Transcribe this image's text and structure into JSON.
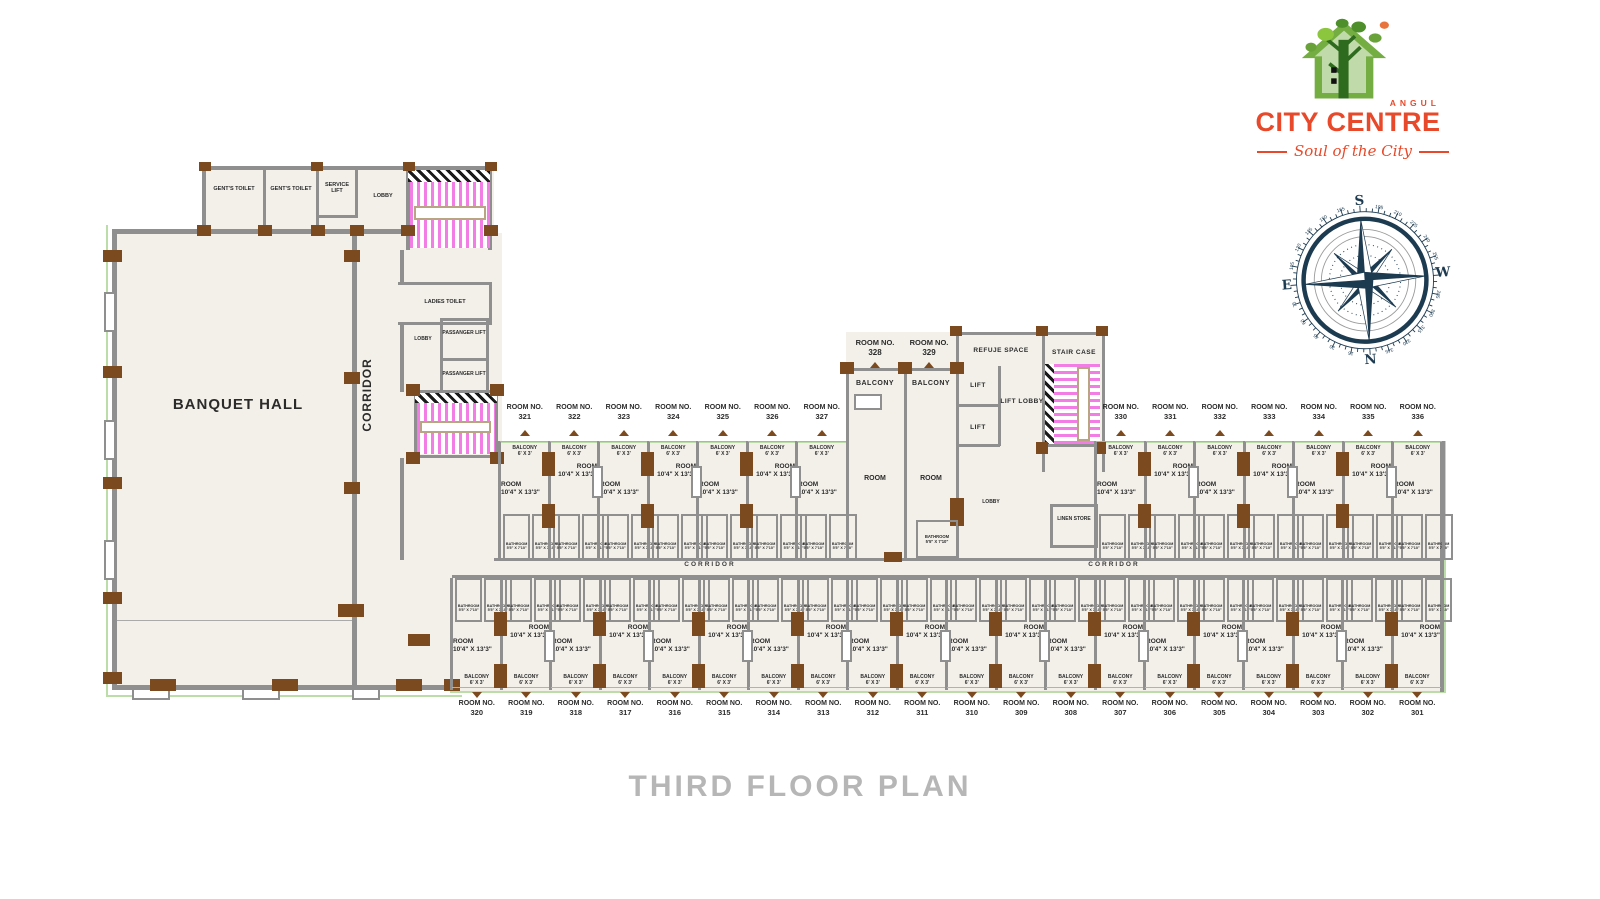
{
  "title": "THIRD FLOOR PLAN",
  "logo": {
    "brand_top": "ANGUL",
    "brand_name": "CITY CENTRE",
    "tagline": "Soul of the City"
  },
  "compass": {
    "s": "S",
    "n": "N",
    "e": "E",
    "w": "W",
    "degrees": [
      15,
      30,
      45,
      60,
      75,
      105,
      120,
      135,
      150,
      165,
      195,
      210,
      225,
      240,
      255,
      285,
      300,
      315,
      330,
      345
    ]
  },
  "left": {
    "gents_toilet": "GENT'S TOILET",
    "gents_toilet_2": "GENT'S TOILET",
    "service_lift": "SERVICE LIFT",
    "lobby": "LOBBY",
    "banquet_hall": "BANQUET HALL",
    "corridor": "CORRIDOR",
    "ladies_toilet": "LADIES TOILET",
    "lobby_2": "LOBBY",
    "passanger_lift": "PASSANGER LIFT",
    "passanger_lift_2": "PASSANGER LIFT"
  },
  "mid": {
    "room_no_label": "ROOM NO.",
    "room_328": "328",
    "room_329": "329",
    "balcony": "BALCONY",
    "room": "ROOM",
    "refuje_space": "REFUJE SPACE",
    "stair_case": "STAIR CASE",
    "lift_1": "LIFT",
    "lift_2": "LIFT",
    "lift_lobby": "LIFT LOBBY",
    "lobby": "LOBBY",
    "linen_store": "LINEN STORE",
    "bathroom": "BATHROOM",
    "bathroom_dims": "5'5\" X 7'10\""
  },
  "corridors": {
    "h1": "CORRIDOR",
    "h2": "CORRIDOR"
  },
  "room_defaults": {
    "room_no_label": "ROOM NO.",
    "room_label": "ROOM",
    "room_dims": "10'4\" X 13'3\"",
    "balcony_label": "BALCONY",
    "balcony_dims": "6' X 3'",
    "bathroom_label": "BATHROOM",
    "bathroom_dims": "5'5\" X 7'10\""
  },
  "rooms": {
    "top_left": [
      "321",
      "322",
      "323",
      "324",
      "325",
      "326",
      "327"
    ],
    "top_right": [
      "330",
      "331",
      "332",
      "333",
      "334",
      "335",
      "336"
    ],
    "bottom": [
      "320",
      "319",
      "318",
      "317",
      "316",
      "315",
      "314",
      "313",
      "312",
      "311",
      "310",
      "309",
      "308",
      "307",
      "306",
      "305",
      "304",
      "303",
      "302",
      "301"
    ]
  },
  "colors": {
    "wall": "#8f8f8f",
    "column": "#7b4a1f",
    "stair_pink": "#f27de4",
    "floor": "#f3f0ea",
    "outline_green": "#bcdcaa",
    "brand_red": "#e8492a",
    "compass_navy": "#1c3a50",
    "title_gray": "#b6b6b6",
    "ink": "#2b2b2b"
  }
}
